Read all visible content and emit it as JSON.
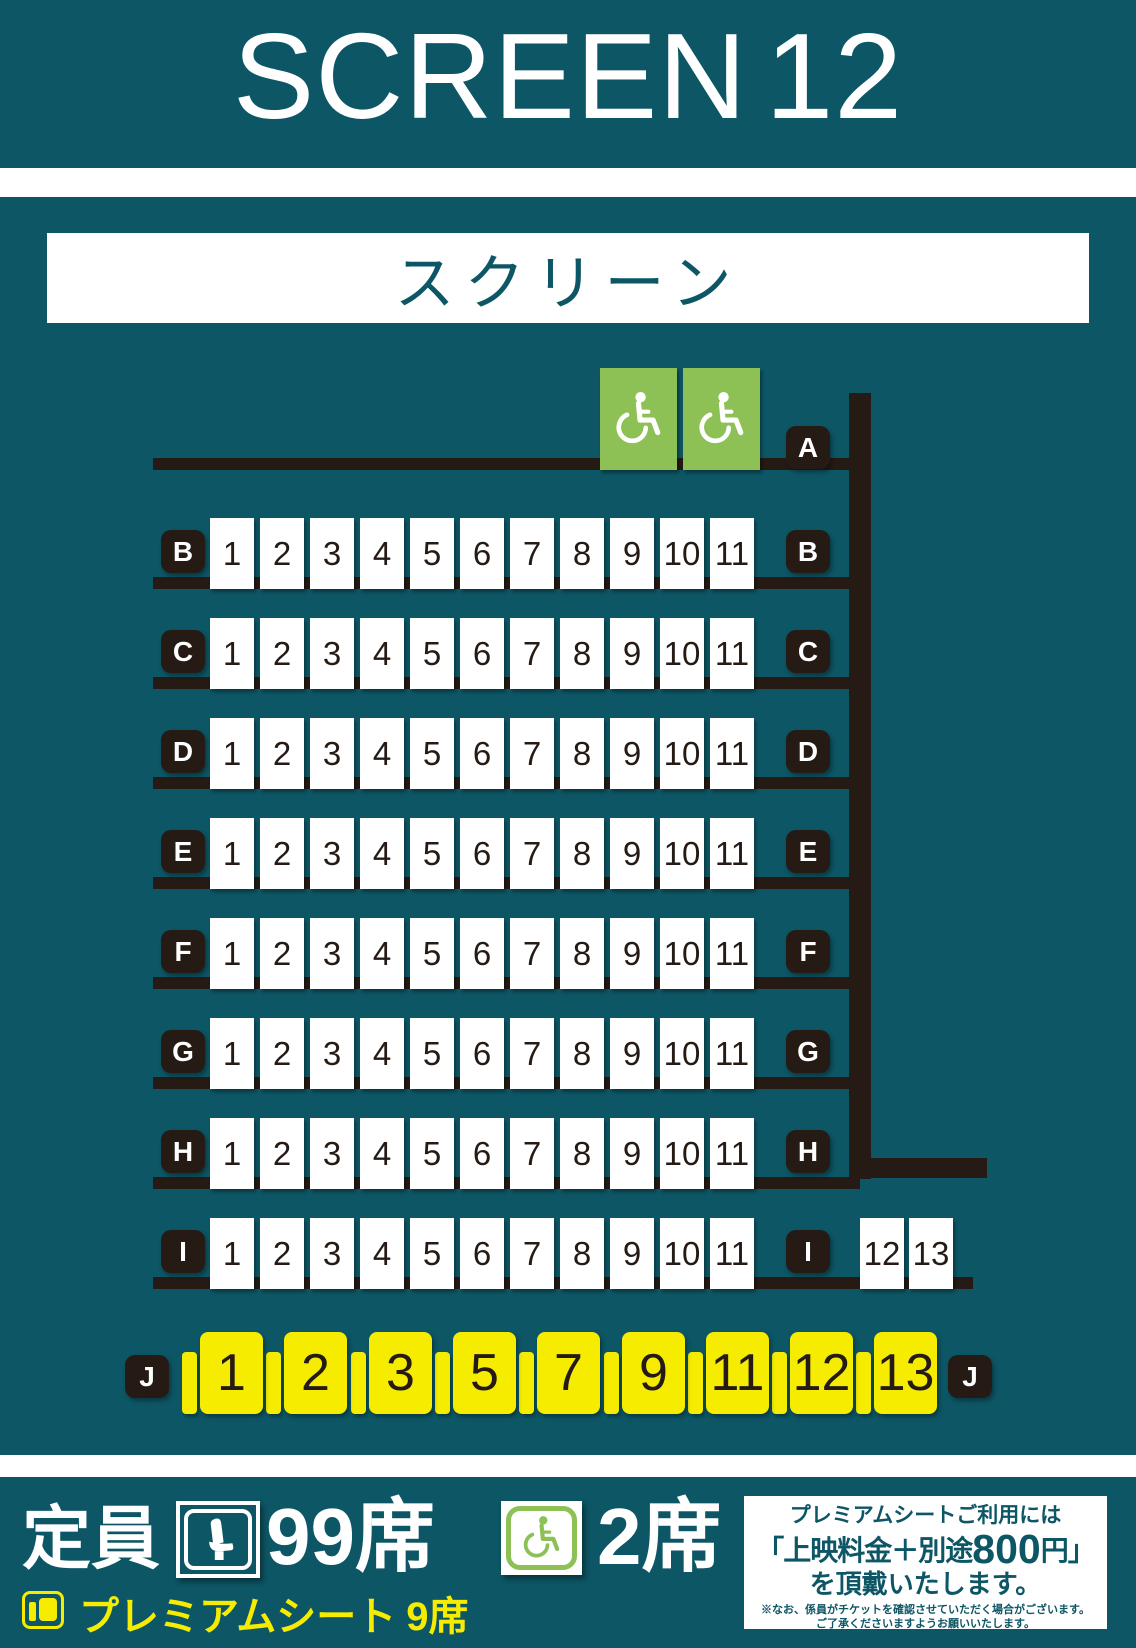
{
  "title": {
    "main": "SCREEN",
    "number": "12"
  },
  "screen_label": "スクリーン",
  "colors": {
    "teal": "#0d5665",
    "ink": "#251a14",
    "yellow": "#f6ec00",
    "green": "#8dc156",
    "white": "#ffffff"
  },
  "seatmap": {
    "wheelchair_row": {
      "letter": "A",
      "wheelchair_seat_count": 2
    },
    "standard_rows": {
      "letters": [
        "B",
        "C",
        "D",
        "E",
        "F",
        "G",
        "H",
        "I"
      ],
      "seat_labels": [
        "1",
        "2",
        "3",
        "4",
        "5",
        "6",
        "7",
        "8",
        "9",
        "10",
        "11"
      ]
    },
    "row_i_extra_seats": [
      "12",
      "13"
    ],
    "premium_row": {
      "letter": "J",
      "seat_labels": [
        "1",
        "2",
        "3",
        "5",
        "7",
        "9",
        "11",
        "12",
        "13"
      ]
    }
  },
  "legend": {
    "capacity_label": "定員",
    "capacity_value": "99席",
    "wheelchair_value": "2席",
    "premium_label": "プレミアムシート",
    "premium_value": "9席"
  },
  "info_box": {
    "line1": "プレミアムシートご利用には",
    "price_prefix": "「上映料金＋別途",
    "price_number": "800",
    "price_suffix": "円」",
    "line3": "を頂戴いたします。",
    "note1": "※なお、係員がチケットを確認させていただく場合がございます。",
    "note2": "ご了承くださいますようお願いいたします。"
  }
}
